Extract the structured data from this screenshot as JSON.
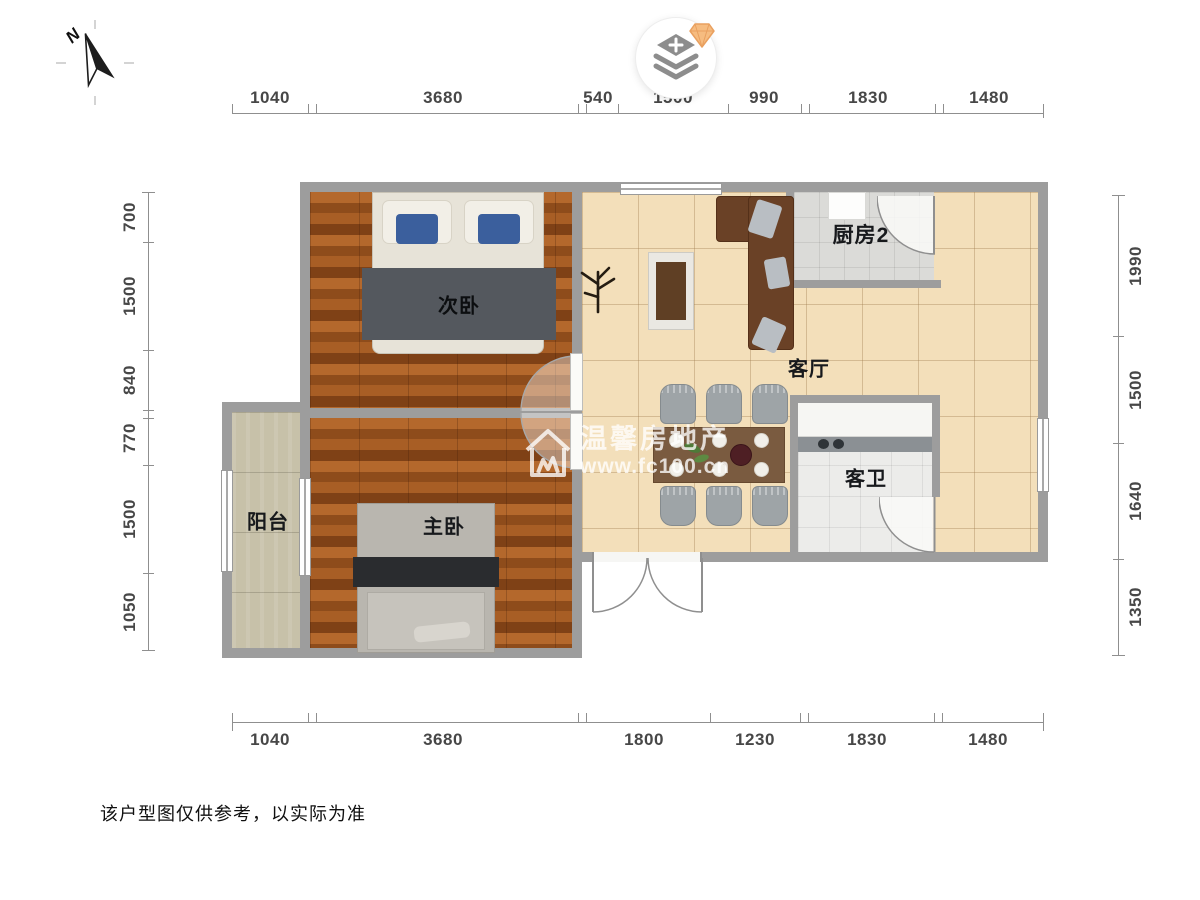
{
  "compass": {
    "label": "N"
  },
  "dimensions": {
    "top": [
      "1040",
      "3680",
      "540",
      "1500",
      "990",
      "1830",
      "1480"
    ],
    "bottom": [
      "1040",
      "3680",
      "1800",
      "1230",
      "1830",
      "1480"
    ],
    "left": [
      "700",
      "1500",
      "840",
      "770",
      "1500",
      "1050"
    ],
    "right": [
      "1990",
      "1500",
      "1640",
      "1350"
    ]
  },
  "rooms": {
    "secondary_bedroom": {
      "label": "次卧"
    },
    "master_bedroom": {
      "label": "主卧"
    },
    "balcony": {
      "label": "阳台"
    },
    "living_room": {
      "label": "客厅"
    },
    "kitchen": {
      "label": "厨房2"
    },
    "guest_bathroom": {
      "label": "客卫"
    }
  },
  "watermark": {
    "brand": "温馨房地产",
    "website": "www.fc100.cn"
  },
  "disclaimer": "该户型图仅供参考，以实际为准",
  "colors": {
    "wall": "#9d9d9d",
    "wood_floor": "#a85e25",
    "living_tile": "#f3dfba",
    "balcony_tile": "#c7c1a9",
    "kitchen_tile": "#dbdbd8",
    "sofa": "#6a4126",
    "gem_accent": "#f6bc80",
    "pillow_blue": "#3b5f9d"
  }
}
